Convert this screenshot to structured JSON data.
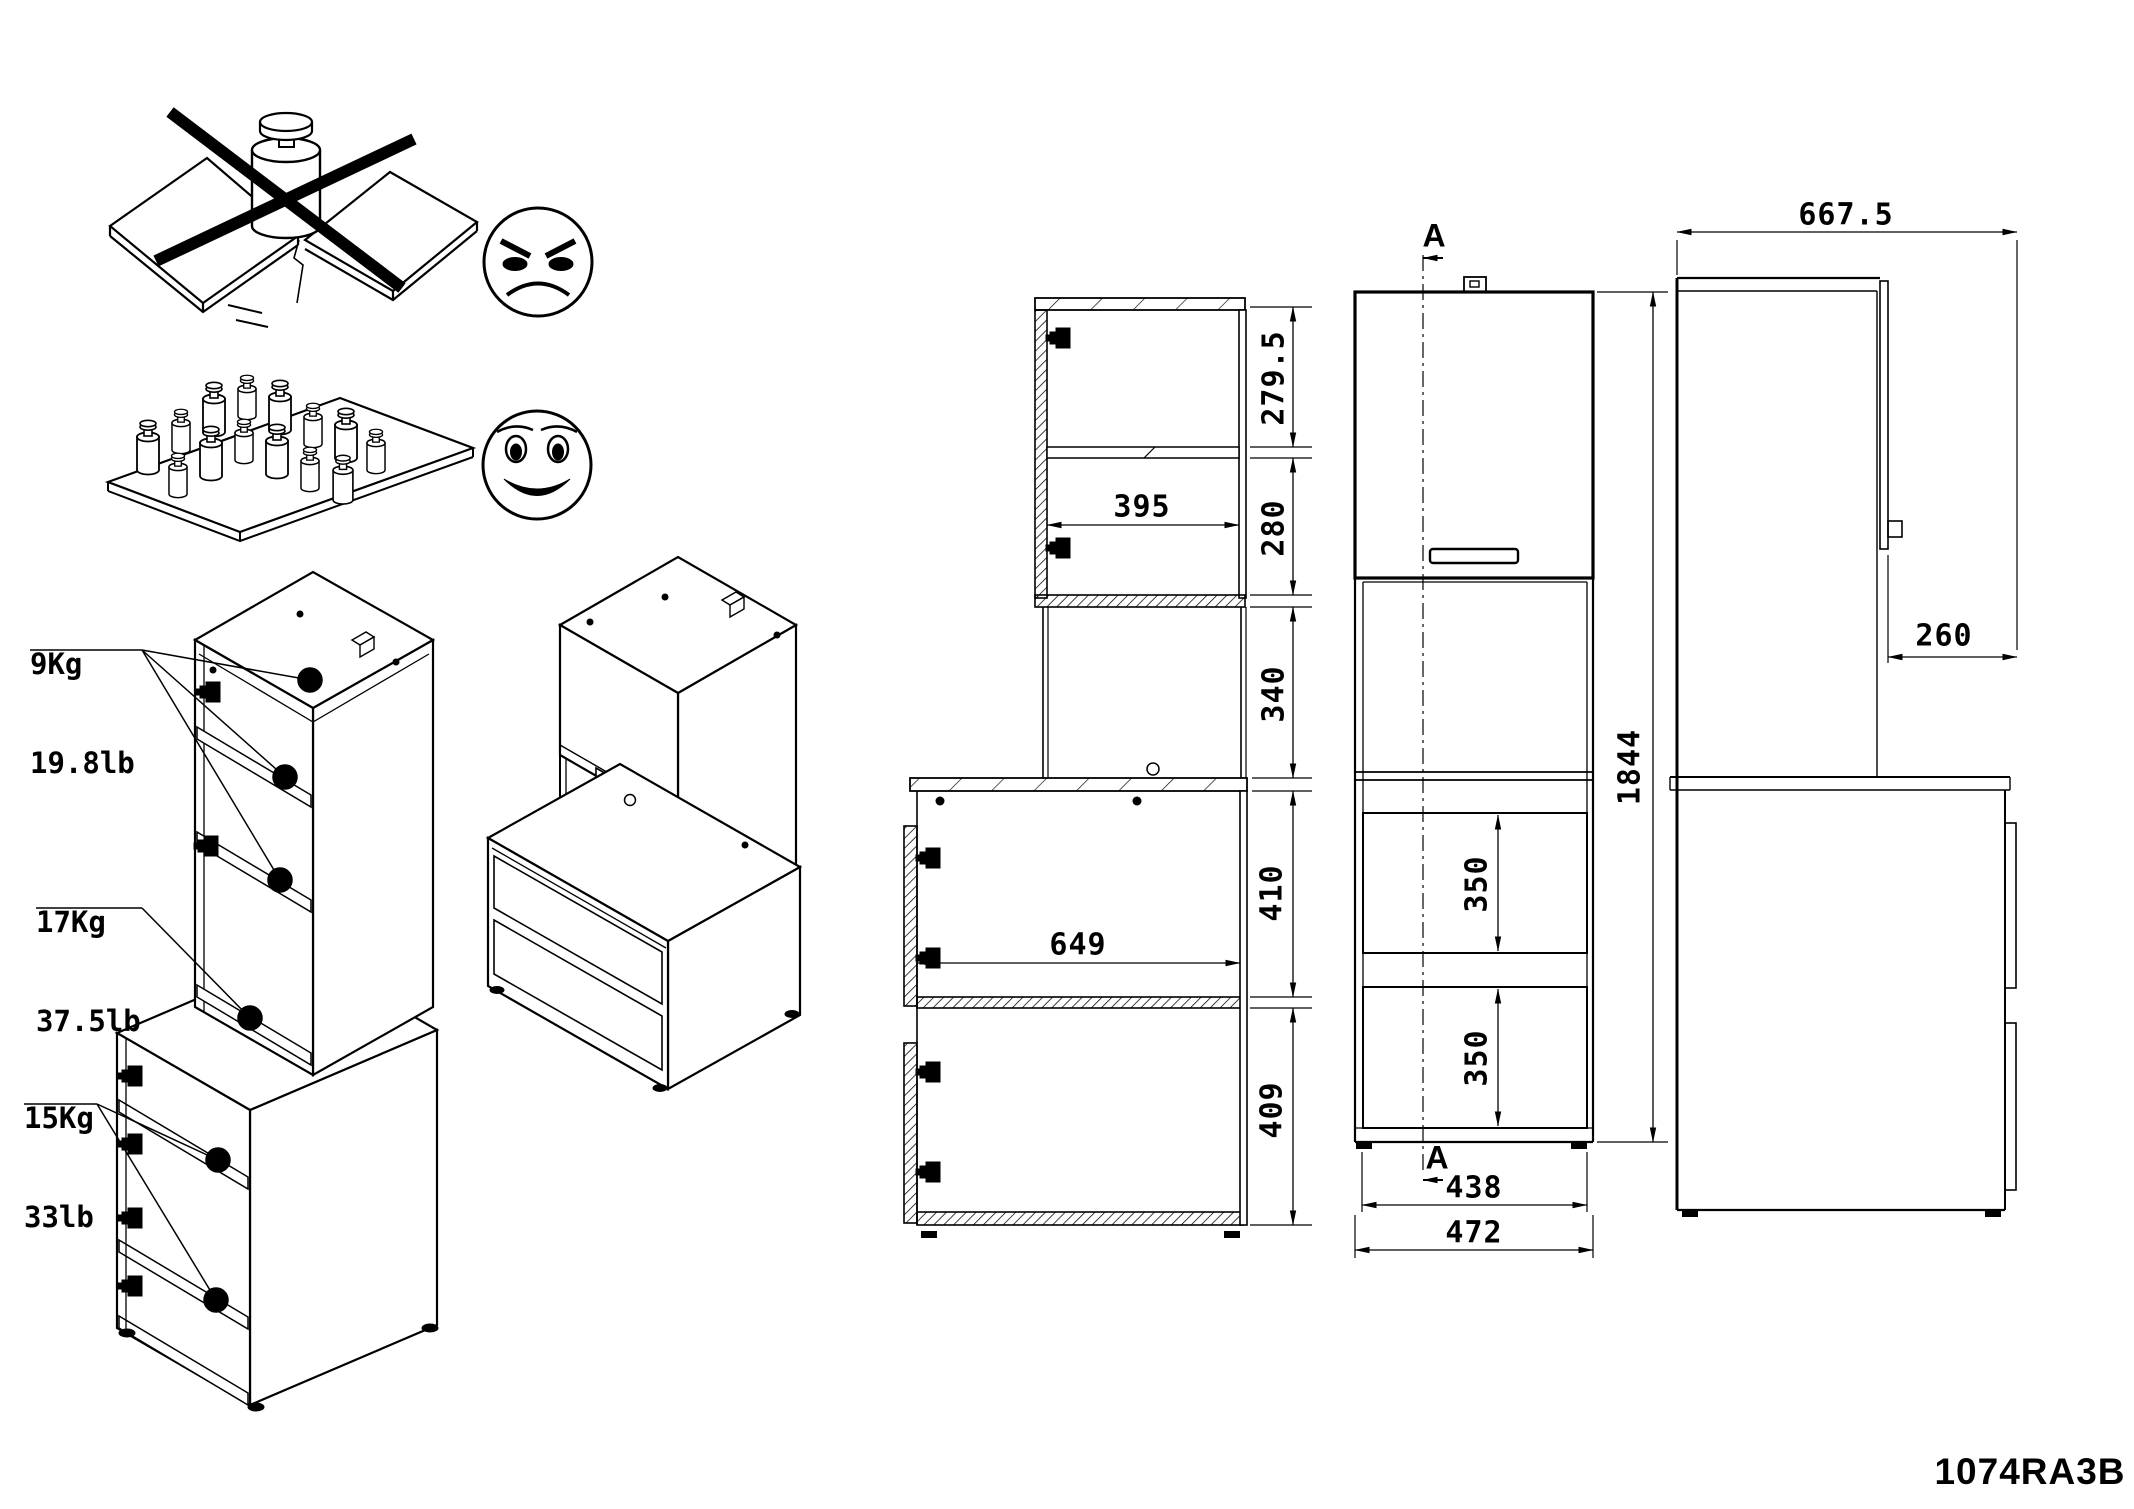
{
  "document": {
    "type": "furniture-assembly-dimension-sheet",
    "model_number": "1074RA3B",
    "background_color": "#ffffff",
    "line_color": "#000000"
  },
  "warnings": {
    "wrong": {
      "icon": "single-heavy-weight-on-bending-shelf-crossed-out",
      "face": "angry-face"
    },
    "correct": {
      "icon": "many-small-weights-distributed-on-flat-shelf",
      "face": "happy-face"
    }
  },
  "load_limits": [
    {
      "part": "upper-unit-shelves",
      "kg": "9Kg",
      "lb": "19.8lb"
    },
    {
      "part": "upper-unit-bottom-board",
      "kg": "17Kg",
      "lb": "37.5lb"
    },
    {
      "part": "base-unit-shelves",
      "kg": "15Kg",
      "lb": "33lb"
    }
  ],
  "section_view": {
    "inner_width_top": "395",
    "compartment_1_height": "279.5",
    "compartment_2_height": "280",
    "gap_height": "340",
    "inner_width_base": "649",
    "base_compartment_1_height": "410",
    "base_compartment_2_height": "409"
  },
  "front_view": {
    "section_marker_top": "A",
    "section_marker_bottom": "A",
    "drawer_1_height": "350",
    "drawer_2_height": "350",
    "inner_width": "438",
    "outer_width": "472",
    "total_height": "1844"
  },
  "side_view": {
    "total_depth": "667.5",
    "upper_cabinet_depth": "260"
  }
}
